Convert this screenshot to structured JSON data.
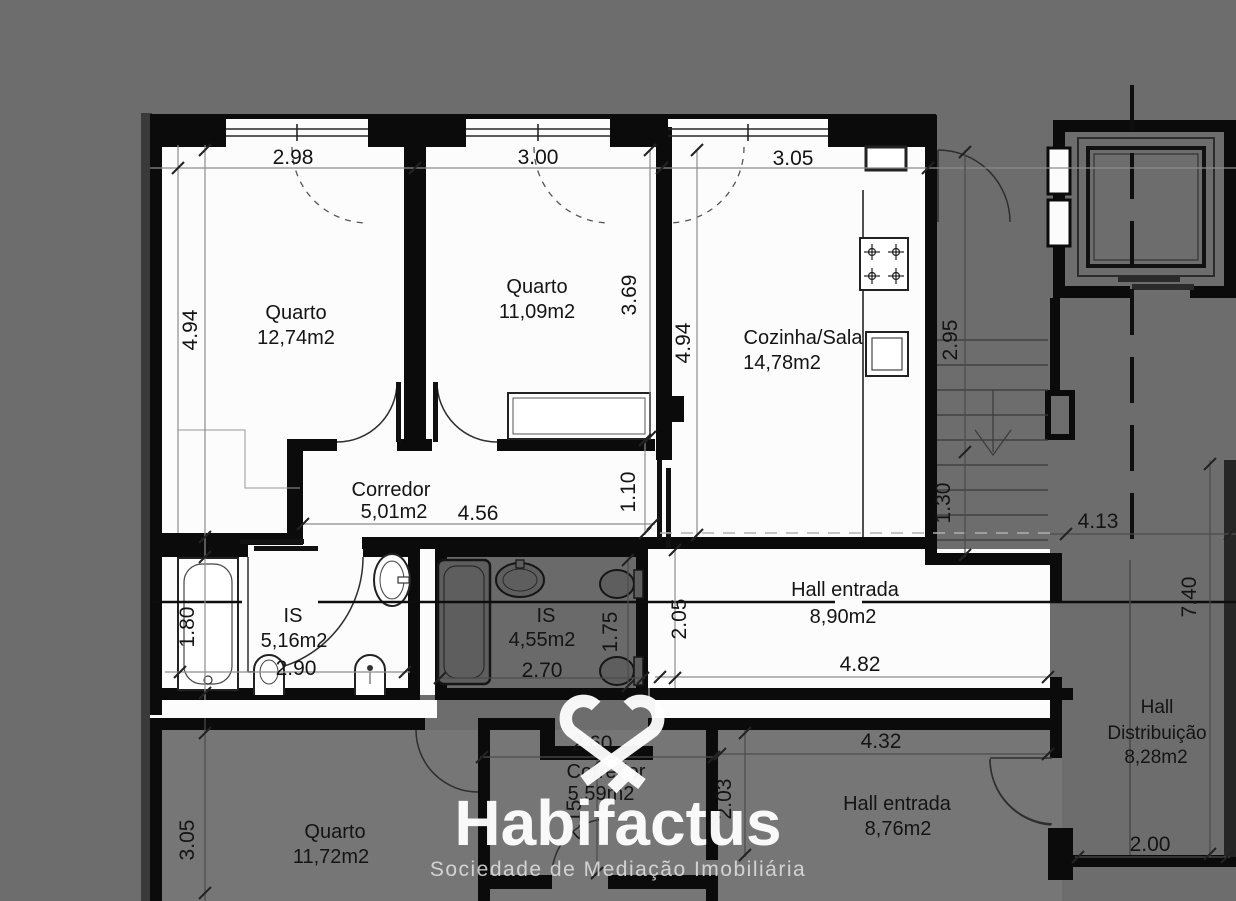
{
  "watermark": {
    "brand": "Habifactus",
    "tagline": "Sociedade de Mediação Imobiliária",
    "logo": "heart-ribbon-logo"
  },
  "upper_unit": {
    "quarto1": {
      "name": "Quarto",
      "area": "12,74m2",
      "dim_width": "2.98",
      "dim_height": "4.94"
    },
    "quarto2": {
      "name": "Quarto",
      "area": "11,09m2",
      "dim_width": "3.00",
      "dim_height": "3.69"
    },
    "cozinha_sala": {
      "name": "Cozinha/Sala",
      "area": "14,78m2",
      "dim_width": "3.05",
      "dim_height": "4.94"
    },
    "corredor": {
      "name": "Corredor",
      "area": "5,01m2",
      "dim_length": "4.56",
      "dim_width": "1.10"
    },
    "is_1": {
      "name": "IS",
      "area": "5,16m2",
      "dim_width": "2.90",
      "dim_height": "1.80"
    },
    "is_2": {
      "name": "IS",
      "area": "4,55m2",
      "dim_width": "2.70",
      "dim_height": "1.75"
    },
    "hall_entrada": {
      "name": "Hall entrada",
      "area": "8,90m2",
      "dim_length": "4.82",
      "dim_height": "2.05"
    }
  },
  "common_areas": {
    "stairs": {
      "dim_width": "2.95",
      "dim_run": "1.30"
    },
    "hall_distribuicao": {
      "name_line1": "Hall",
      "name_line2": "Distribuição",
      "area": "8,28m2",
      "dim_width": "4.13",
      "dim_depth": "7.40",
      "dim_lower": "2.00"
    }
  },
  "lower_unit": {
    "quarto": {
      "name": "Quarto",
      "area": "11,72m2",
      "dim_height": "3.05"
    },
    "corredor": {
      "name": "Corredor",
      "area": "5,59m2",
      "dim_width": "2.60",
      "dim_depth": "2.15"
    },
    "hall_entrada": {
      "name": "Hall entrada",
      "area": "8,76m2",
      "dim_length": "4.32",
      "dim_depth": "2.03"
    }
  },
  "colors": {
    "background": "#6d6d6d",
    "apartment_fill": "#fcfcfc",
    "walls": "#0b0b0b",
    "shaded_unit": "#767676",
    "shaded_bathroom": "#6a6a6a",
    "watermark": "#ffffff"
  }
}
